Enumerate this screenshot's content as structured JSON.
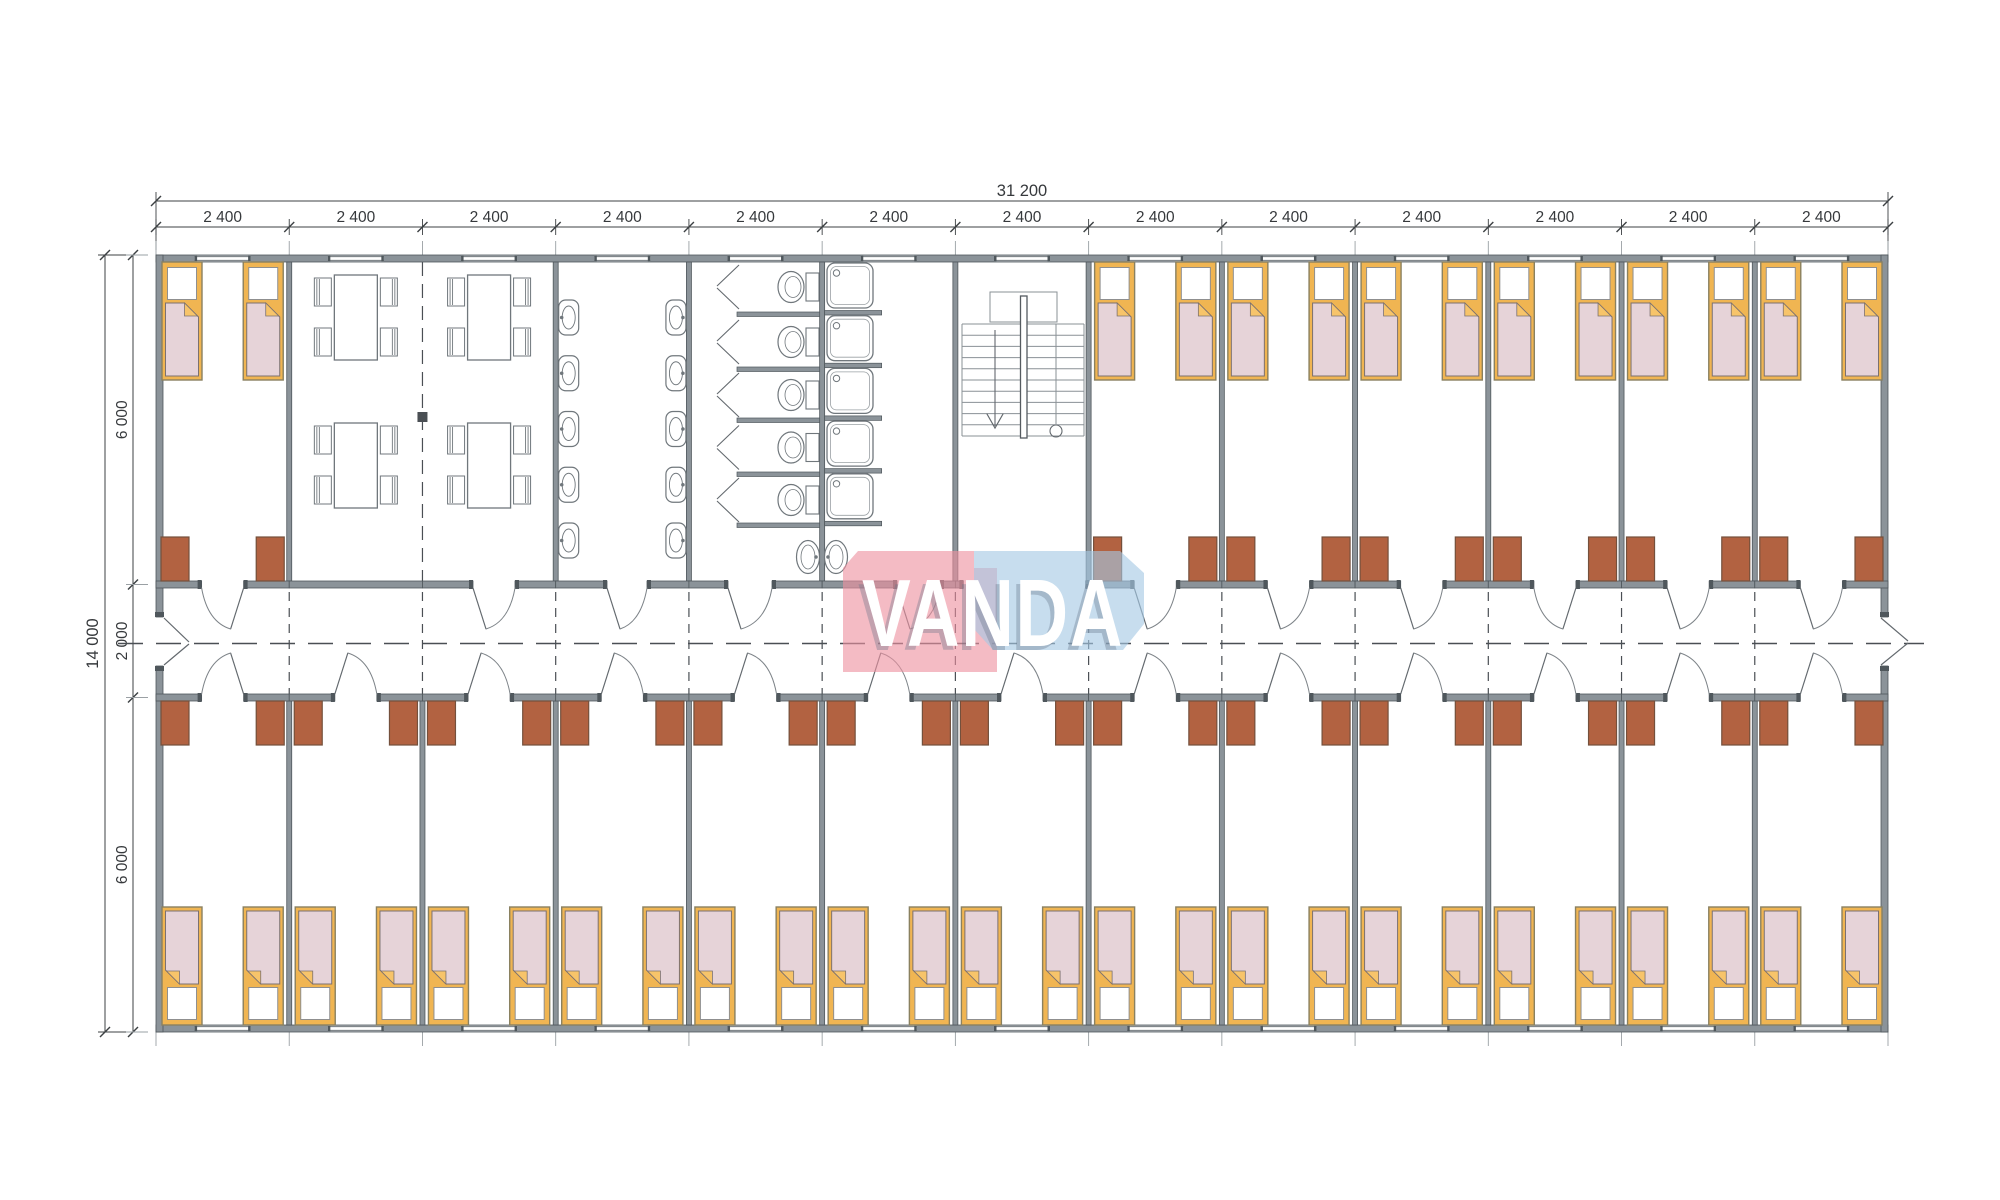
{
  "logo": {
    "text": "VANDA",
    "pink_block": "#f5bdc6",
    "blue_block": "#cfe3f0",
    "text_color": "#ffffff"
  },
  "dimensions": {
    "total_width": "31 200",
    "module_width": "2 400",
    "module_count": 13,
    "total_height": "14 000",
    "height_segments": [
      "6 000",
      "2 000",
      "6 000"
    ]
  },
  "rooms": {
    "top_row": [
      "bedroom",
      "dining hall",
      "dining hall",
      "washroom",
      "toilets",
      "showers",
      "stairwell",
      "bedroom",
      "bedroom",
      "bedroom",
      "bedroom",
      "bedroom",
      "bedroom"
    ],
    "bottom_row": [
      "bedroom",
      "bedroom",
      "bedroom",
      "bedroom",
      "bedroom",
      "bedroom",
      "bedroom",
      "bedroom",
      "bedroom",
      "bedroom",
      "bedroom",
      "bedroom",
      "bedroom"
    ]
  },
  "fixtures": {
    "beds": 40,
    "wardrobes": 40,
    "washbasins": 10,
    "toilet_stalls": 5,
    "shower_stalls": 5,
    "dining_tables": 4,
    "dining_chairs_per_table": 4
  },
  "colors": {
    "wall_fill": "#8b9399",
    "wall_edge": "#4f575c",
    "line": "#70777c",
    "dash": "#4a4f54",
    "bed_frame": "#f0b552",
    "bed_frame_edge": "#8a8160",
    "mattress": "#e6d3d8",
    "mattress_edge": "#7c7170",
    "pillow": "#ffffff",
    "fold": "#f7c46a",
    "wardrobe": "#b26241",
    "wardrobe_edge": "#74503c",
    "dim_line": "#3c4043",
    "fixture": "#ffffff"
  }
}
